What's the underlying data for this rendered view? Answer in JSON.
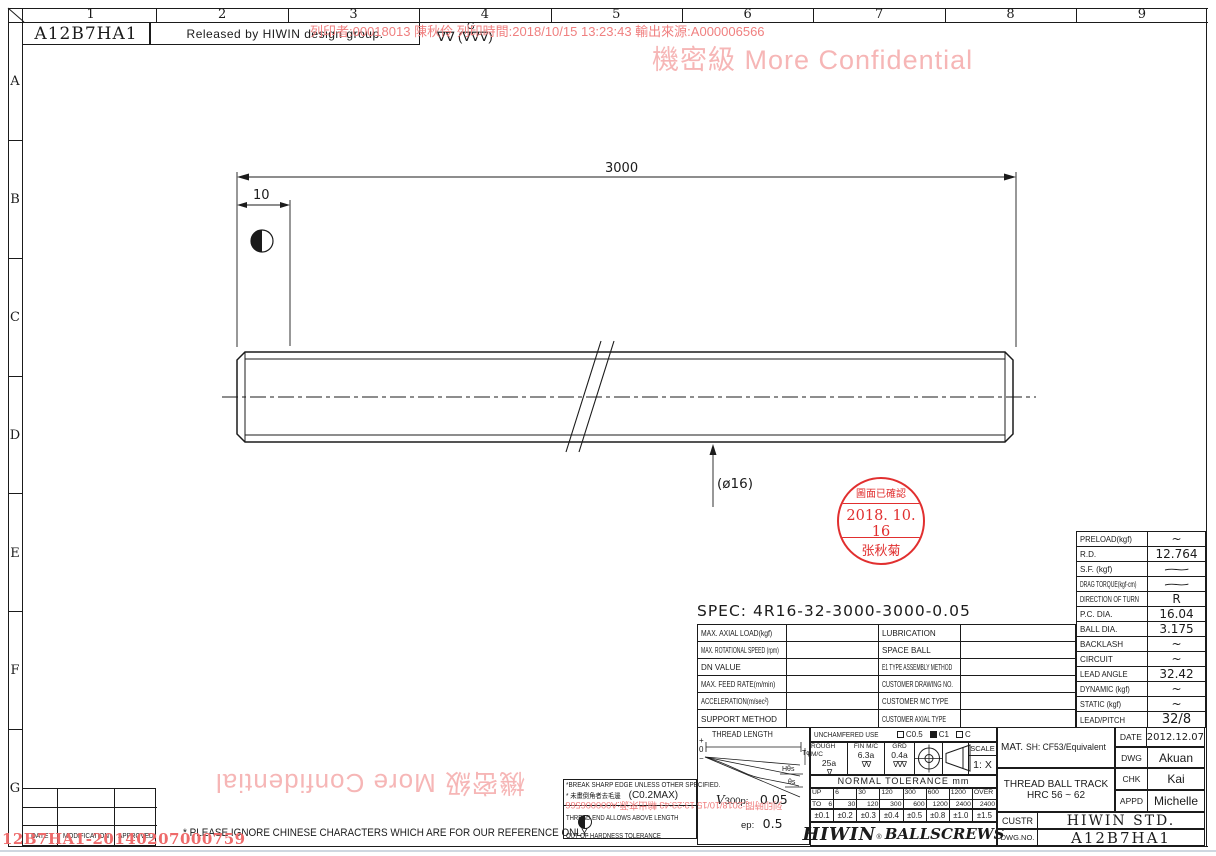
{
  "frame": {
    "cols": [
      "1",
      "2",
      "3",
      "4",
      "5",
      "6",
      "7",
      "8",
      "9"
    ],
    "rows": [
      "A",
      "B",
      "C",
      "D",
      "E",
      "F",
      "G"
    ]
  },
  "header": {
    "doc_no": "A12B7HA1",
    "release": "Released by HIWIN design group.",
    "finish_g": "G",
    "finish_marks": "∇∇ (∇∇∇)"
  },
  "watermark": {
    "confidential": "機密級 More Confidential",
    "print_info": "列印者:00018013 陳秋伶 列印時間:2018/10/15 13:23:43 輸出來源:A000006566",
    "print_info_partial": "列印時間:2018/10/15 13:23:43 輸出來源:A000006566",
    "footer_code": "12B7HA1-20140207000759"
  },
  "drawing": {
    "dim_overall": "3000",
    "dim_end": "10",
    "dia": "(ø16)"
  },
  "stamp": {
    "line1": "圖面已確認",
    "line2": "2018. 10. 16",
    "line3": "张秋菊"
  },
  "spec": {
    "title": "SPEC: 4R16-32-3000-3000-0.05",
    "rows": [
      {
        "l": "MAX. AXIAL LOAD(kgf)",
        "r": "LUBRICATION"
      },
      {
        "l": "MAX. ROTATIONAL SPEED (rpm)",
        "r": "SPACE BALL"
      },
      {
        "l": "DN VALUE",
        "r": "E1 TYPE ASSEMBLY METHOD"
      },
      {
        "l": "MAX. FEED RATE(m/min)",
        "r": "CUSTOMER DRAWING NO."
      },
      {
        "l": "ACCELERATION(m/sec²)",
        "r": "CUSTOMER MC TYPE"
      },
      {
        "l": "SUPPORT METHOD",
        "r": "CUSTOMER AXIAL TYPE"
      }
    ]
  },
  "params": {
    "rows": [
      {
        "label": "PRELOAD(kgf)",
        "value": "~"
      },
      {
        "label": "R.D.",
        "value": "12.764"
      },
      {
        "label": "S.F.  (kgf)",
        "value": "∼"
      },
      {
        "label": "DRAG TORQUE(kgf-cm)",
        "value": "∼"
      },
      {
        "label": "DIRECTION OF TURN",
        "value": "R"
      },
      {
        "label": "P.C. DIA.",
        "value": "16.04"
      },
      {
        "label": "BALL DIA.",
        "value": "3.175"
      },
      {
        "label": "BACKLASH",
        "value": "~"
      },
      {
        "label": "CIRCUIT",
        "value": "~"
      },
      {
        "label": "LEAD ANGLE",
        "value": "32.42"
      },
      {
        "label": "DYNAMIC   (kgf)",
        "value": "~"
      },
      {
        "label": "STATIC    (kgf)",
        "value": "~"
      },
      {
        "label": "LEAD/PITCH",
        "value": "32/8"
      }
    ]
  },
  "thread_diagram": {
    "title": "THREAD LENGTH",
    "plus": "+",
    "zero": "0",
    "minus": "−",
    "t_label": "Tφ",
    "h_label": "Hθs",
    "s_label": "θs",
    "v300_v": "V",
    "v300_rest": "300p:",
    "v300_value": "0.05",
    "ep_label": "ep:",
    "ep_value": "0.5"
  },
  "process": {
    "unchamfered": "UNCHAMFERED USE",
    "c05": "C0.5",
    "c1": "C1",
    "c": "C",
    "cells": [
      {
        "label": "ROUGH M/C",
        "value": "25a",
        "marks": "∇"
      },
      {
        "label": "FIN M/C",
        "value": "6.3a",
        "marks": "∇∇"
      },
      {
        "label": "GRD",
        "value": "0.4a",
        "marks": "∇∇∇"
      }
    ],
    "scale_label": "SCALE",
    "scale_value": "1: X"
  },
  "tolerance": {
    "title": "NORMAL TOLERANCE mm",
    "up": "UP",
    "to": "TO",
    "cols": [
      {
        "up": "",
        "to": "6"
      },
      {
        "up": "6",
        "to": "30"
      },
      {
        "up": "30",
        "to": "120"
      },
      {
        "up": "120",
        "to": "300"
      },
      {
        "up": "300",
        "to": "600"
      },
      {
        "up": "600",
        "to": "1200"
      },
      {
        "up": "1200",
        "to": "2400"
      },
      {
        "up": "OVER",
        "to": "2400"
      }
    ],
    "values": [
      "±0.1",
      "±0.2",
      "±0.3",
      "±0.4",
      "±0.5",
      "±0.8",
      "±1.0",
      "±1.5"
    ]
  },
  "title_block": {
    "mat_label": "MAT.",
    "mat_value": "SH: CF53/Equivalent",
    "thread_line1": "THREAD BALL TRACK",
    "thread_line2": "HRC 56 ~ 62",
    "date_label": "DATE",
    "date_value": "2012.12.07",
    "dwg_label": "DWG",
    "dwg_value": "Akuan",
    "chk_label": "CHK",
    "chk_value": "Kai",
    "appd_label": "APPD",
    "appd_value": "Michelle",
    "custr_label": "CUSTR",
    "custr_value": "HIWIN  STD.",
    "dwgno_label": "DWG.NO.",
    "dwgno_value": "A12B7HA1",
    "logo_main": "HIWIN",
    "logo_reg": "®",
    "logo_sub": "BALLSCREWS"
  },
  "notes": {
    "line1": "*BREAK SHARP EDGE UNLESS OTHER SPECIFIED.",
    "line2": "* 未畫倒角者去毛邊",
    "line2b": "(C0.2MAX)",
    "line3": "THREAD END ALLOWS ABOVE LENGTH",
    "line4": "OUT OF HARDNESS TOLERANCE",
    "ignore": "* PLEASE IGNORE CHINESE CHARACTERS WHICH ARE FOR OUR REFERENCE ONLY."
  },
  "revision": {
    "headers": [
      "DATE",
      "MODIFICATION",
      "APPROVED"
    ]
  }
}
